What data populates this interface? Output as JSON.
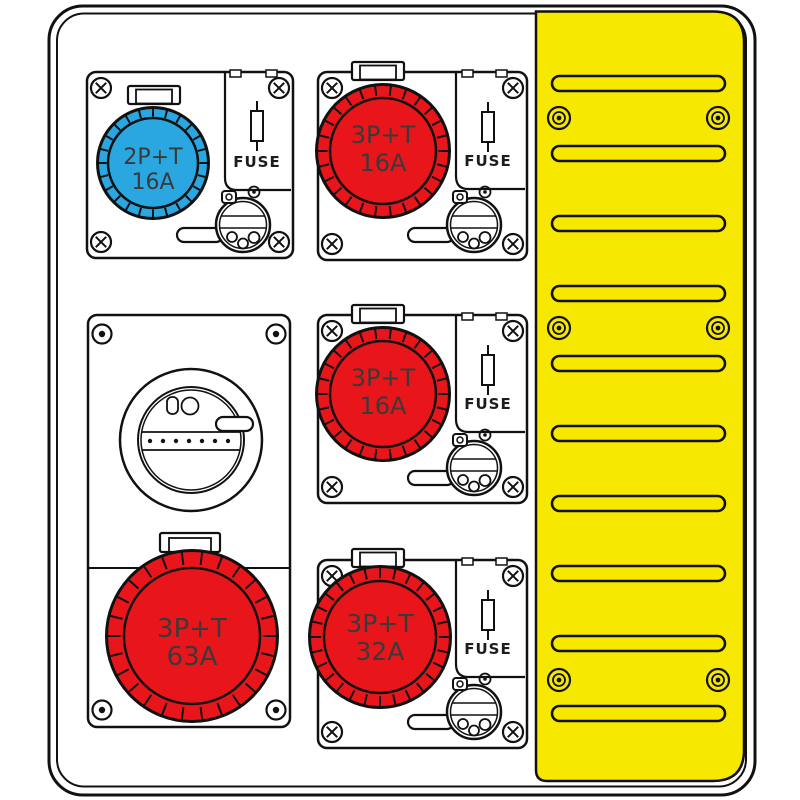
{
  "colors": {
    "panel_yellow": "#F7E800",
    "socket_blue": "#2AA7E0",
    "socket_red": "#E8161B",
    "outline": "#111111",
    "label_text": "#3A3A3A"
  },
  "modules": [
    {
      "id": "blue-socket-16a-top-left",
      "socket": {
        "line1": "2P+T",
        "line2": "16A"
      },
      "fuse_label": "FUSE"
    },
    {
      "id": "red-socket-16a-top",
      "socket": {
        "line1": "3P+T",
        "line2": "16A"
      },
      "fuse_label": "FUSE"
    },
    {
      "id": "red-socket-16a-middle",
      "socket": {
        "line1": "3P+T",
        "line2": "16A"
      },
      "fuse_label": "FUSE"
    },
    {
      "id": "red-socket-63a-interlocked",
      "socket": {
        "line1": "3P+T",
        "line2": "63A"
      }
    },
    {
      "id": "red-socket-32a-bottom",
      "socket": {
        "line1": "3P+T",
        "line2": "32A"
      },
      "fuse_label": "FUSE"
    }
  ],
  "side_panel": {
    "slot_count": 10,
    "screw_pair_rows": [
      118,
      328,
      680
    ],
    "screw_pair_cols": [
      559,
      718
    ]
  }
}
